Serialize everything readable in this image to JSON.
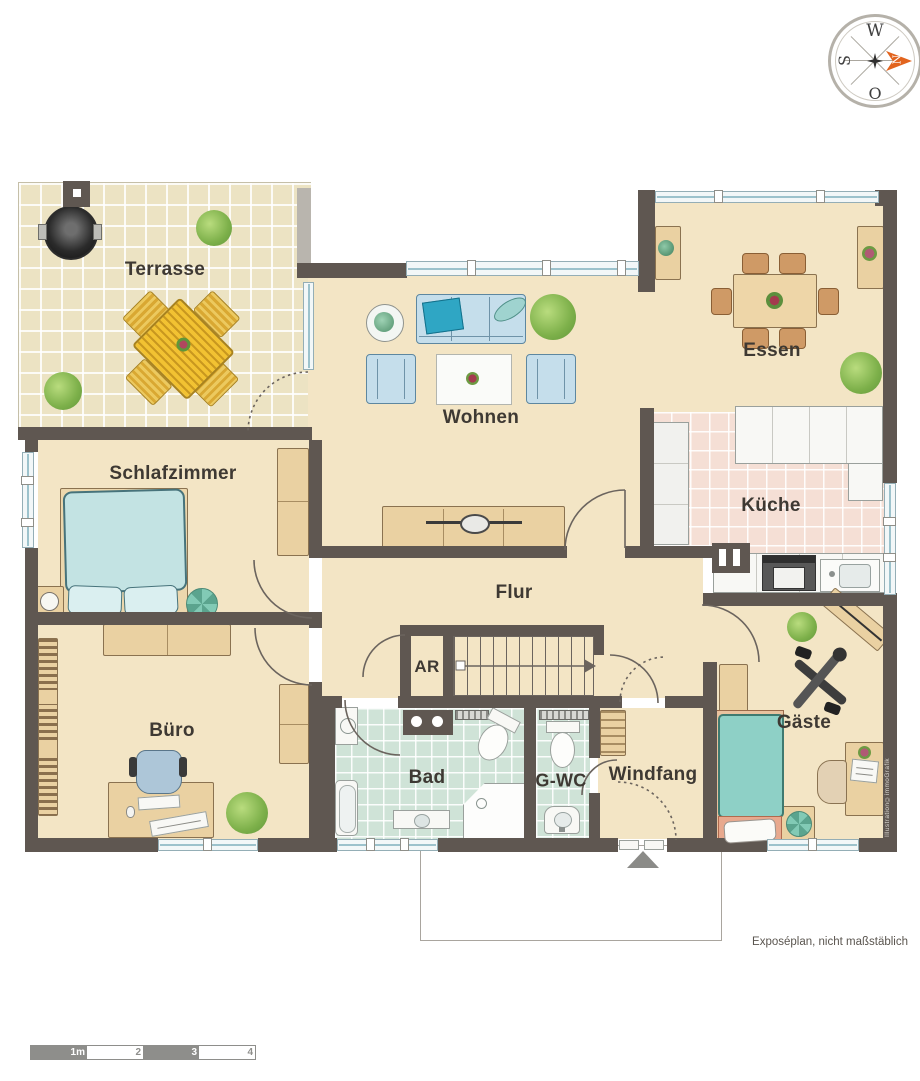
{
  "rooms": {
    "terrasse": {
      "label": "Terrasse"
    },
    "wohnen": {
      "label": "Wohnen"
    },
    "essen": {
      "label": "Essen"
    },
    "kueche": {
      "label": "Küche"
    },
    "schlafzimmer": {
      "label": "Schlafzimmer"
    },
    "flur": {
      "label": "Flur"
    },
    "abstellraum": {
      "label": "AR"
    },
    "buero": {
      "label": "Büro"
    },
    "bad": {
      "label": "Bad"
    },
    "gaeste_wc": {
      "label": "G-WC"
    },
    "windfang": {
      "label": "Windfang"
    },
    "gaeste": {
      "label": "Gäste"
    }
  },
  "compass": {
    "north": "N",
    "south": "S",
    "west": "W",
    "east": "O"
  },
  "scale_bar": {
    "labels": [
      "1m",
      "2",
      "3",
      "4"
    ]
  },
  "notes": {
    "disclaimer": "Exposéplan, nicht maßstäblich",
    "watermark": "Illustration©immoGrafik"
  },
  "colors": {
    "wall": "#5f5751",
    "floor": "#f3e5c5",
    "terrace_tile": "#ece3c3",
    "kitchen_tile": "#f5dfd5",
    "bath_tile": "#cfe3d7",
    "window_glass": "#9cc2cc",
    "wood": "#ead1a2",
    "sofa_blue": "#c5deeb",
    "bed_teal": "#8ed0c6",
    "terrace_table_yellow": "#f2c232",
    "plant_green": "#7db04a",
    "compass_arrow": "#e2641e"
  }
}
